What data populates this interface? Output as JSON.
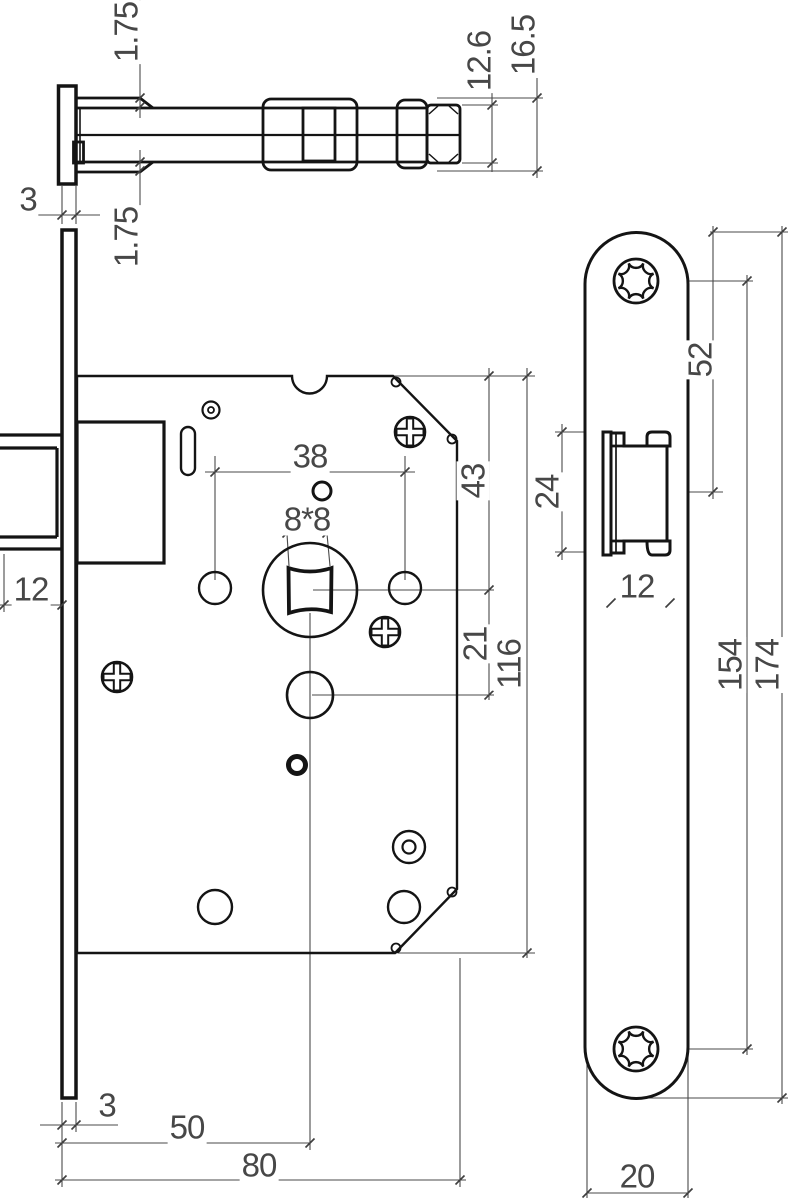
{
  "drawing": {
    "type": "technical-drawing",
    "subject": "mortise-door-lock",
    "colors": {
      "background": "#ffffff",
      "object_line": "#141414",
      "dimension_line": "#4a4a4a",
      "text": "#474747"
    },
    "views": {
      "top_view": {
        "name": "latch-bolt-top-section"
      },
      "front_view": {
        "name": "lock-case-front"
      },
      "side_view": {
        "name": "faceplate-side"
      }
    },
    "dims": {
      "top_view": {
        "offset_top": "1.75",
        "offset_bottom": "1.75",
        "faceplate_thickness": "3",
        "bolt_height": "12.6",
        "overall_height": "16.5"
      },
      "front_view": {
        "hole_spacing": "38",
        "spindle_square": "8*8",
        "top_to_spindle": "43",
        "spindle_to_follower": "21",
        "case_height": "116",
        "latch_protrusion": "12",
        "faceplate_thickness": "3",
        "backset": "50",
        "case_depth": "80"
      },
      "side_view": {
        "top_to_latch": "52",
        "latch_height": "24",
        "latch_width": "12",
        "screw_spacing": "154",
        "plate_length": "174",
        "plate_width": "20"
      }
    }
  }
}
